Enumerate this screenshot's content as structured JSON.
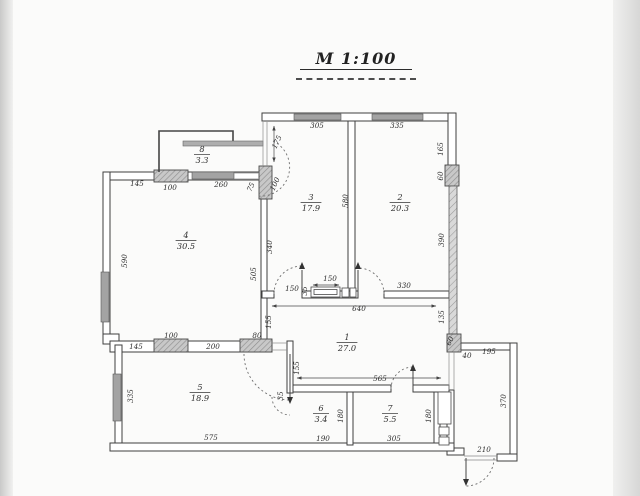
{
  "title": {
    "scale_label": "М 1:100"
  },
  "rooms": [
    {
      "number": "1",
      "area": "27.0",
      "x": 347,
      "y": 334
    },
    {
      "number": "2",
      "area": "20.3",
      "x": 400,
      "y": 194
    },
    {
      "number": "3",
      "area": "17.9",
      "x": 311,
      "y": 194
    },
    {
      "number": "4",
      "area": "30.5",
      "x": 186,
      "y": 232
    },
    {
      "number": "5",
      "area": "18.9",
      "x": 200,
      "y": 384
    },
    {
      "number": "6",
      "area": "3.4",
      "x": 321,
      "y": 405
    },
    {
      "number": "7",
      "area": "5.5",
      "x": 390,
      "y": 405
    },
    {
      "number": "8",
      "area": "3.3",
      "x": 202,
      "y": 146
    }
  ],
  "dimensions": [
    {
      "v": "305",
      "x": 317,
      "y": 128
    },
    {
      "v": "335",
      "x": 397,
      "y": 128
    },
    {
      "v": "165",
      "x": 443,
      "y": 149,
      "r": -90
    },
    {
      "v": "60",
      "x": 443,
      "y": 176,
      "r": -90
    },
    {
      "v": "390",
      "x": 444,
      "y": 240,
      "r": -90
    },
    {
      "v": "135",
      "x": 444,
      "y": 317,
      "r": -90
    },
    {
      "v": "60",
      "x": 452,
      "y": 342,
      "r": -65
    },
    {
      "v": "40",
      "x": 467,
      "y": 358
    },
    {
      "v": "195",
      "x": 489,
      "y": 354
    },
    {
      "v": "370",
      "x": 506,
      "y": 401,
      "r": -90
    },
    {
      "v": "210",
      "x": 484,
      "y": 452
    },
    {
      "v": "145",
      "x": 137,
      "y": 186
    },
    {
      "v": "100",
      "x": 170,
      "y": 190
    },
    {
      "v": "260",
      "x": 221,
      "y": 187
    },
    {
      "v": "175",
      "x": 279,
      "y": 143,
      "r": -65
    },
    {
      "v": "75",
      "x": 253,
      "y": 188,
      "r": -65
    },
    {
      "v": "100",
      "x": 277,
      "y": 185,
      "r": -65
    },
    {
      "v": "590",
      "x": 127,
      "y": 261,
      "r": -90
    },
    {
      "v": "340",
      "x": 272,
      "y": 247,
      "r": -90
    },
    {
      "v": "505",
      "x": 256,
      "y": 274,
      "r": -90
    },
    {
      "v": "580",
      "x": 348,
      "y": 201,
      "r": -90
    },
    {
      "v": "150",
      "x": 292,
      "y": 291,
      "s": 6.5
    },
    {
      "v": "150",
      "x": 330,
      "y": 281,
      "s": 6.5
    },
    {
      "v": "35",
      "x": 307,
      "y": 291,
      "r": -90,
      "s": 5.5
    },
    {
      "v": "330",
      "x": 404,
      "y": 288
    },
    {
      "v": "640",
      "x": 359,
      "y": 311
    },
    {
      "v": "155",
      "x": 271,
      "y": 322,
      "r": -90
    },
    {
      "v": "145",
      "x": 136,
      "y": 349
    },
    {
      "v": "100",
      "x": 171,
      "y": 338
    },
    {
      "v": "200",
      "x": 213,
      "y": 349
    },
    {
      "v": "80",
      "x": 257,
      "y": 338
    },
    {
      "v": "155",
      "x": 299,
      "y": 368,
      "r": -90
    },
    {
      "v": "35",
      "x": 283,
      "y": 396,
      "r": -90,
      "s": 5.5
    },
    {
      "v": "565",
      "x": 380,
      "y": 381
    },
    {
      "v": "335",
      "x": 133,
      "y": 396,
      "r": -90
    },
    {
      "v": "575",
      "x": 211,
      "y": 440
    },
    {
      "v": "190",
      "x": 323,
      "y": 441
    },
    {
      "v": "305",
      "x": 394,
      "y": 441
    },
    {
      "v": "180",
      "x": 343,
      "y": 416,
      "r": -90
    },
    {
      "v": "180",
      "x": 431,
      "y": 416,
      "r": -90
    }
  ],
  "colors": {
    "paper": "#fbfbfa",
    "line": "#3f3f3f",
    "dim_text": "#2e2e2e",
    "window_fill": "#a3a3a3",
    "pier_fill": "#c8c8c8",
    "hatch_line": "#8f8f8f",
    "door_arc": "#6e6e6e"
  }
}
